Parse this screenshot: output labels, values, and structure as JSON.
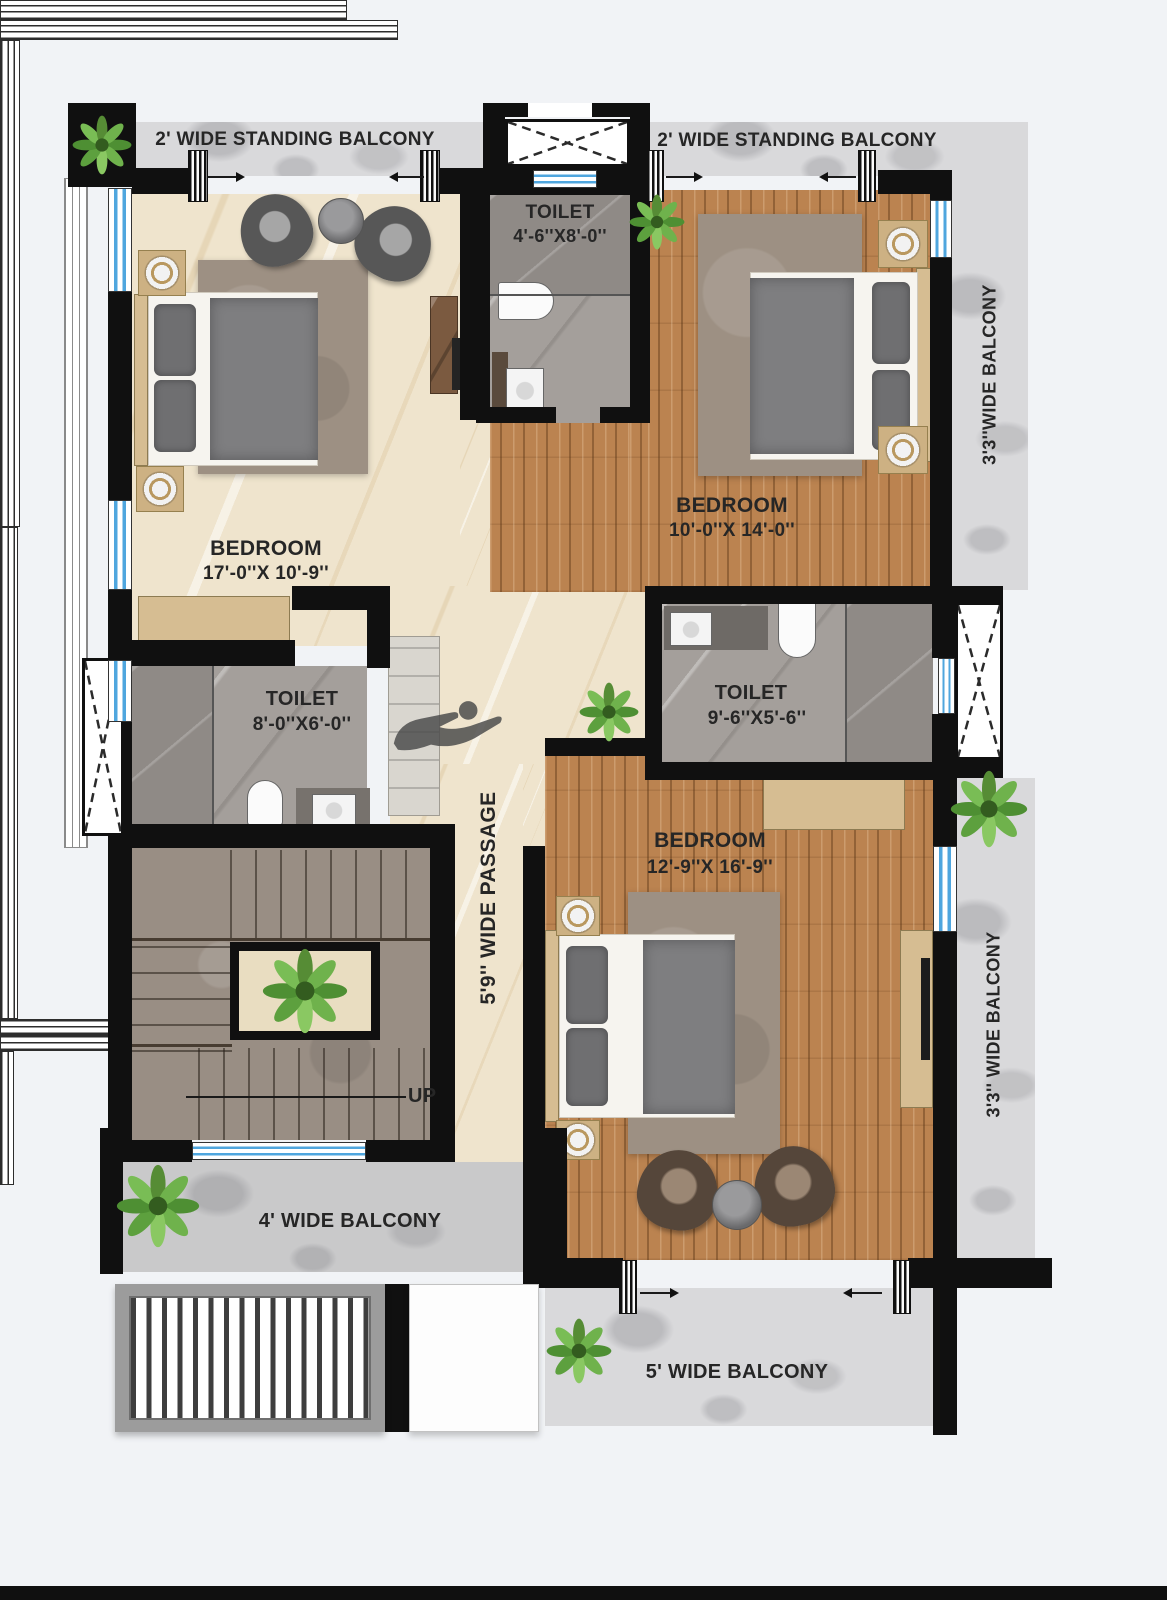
{
  "colors": {
    "wall": "#101010",
    "window_blue": "#4fa6de",
    "wood_floor": "#bb8350",
    "cream_floor": "#efe4cd",
    "balcony_marble": "#d9d9db",
    "toilet_tile": "#a49f9b",
    "stair_stone": "#998e84",
    "text": "#262626",
    "background": "#f1f3f6"
  },
  "balconies": {
    "standing_left": "2' WIDE STANDING BALCONY",
    "standing_right": "2' WIDE STANDING BALCONY",
    "right_upper": "3'3''WIDE BALCONY",
    "right_lower": "3'3'' WIDE BALCONY",
    "bottom_left": "4' WIDE BALCONY",
    "bottom_center": "5' WIDE BALCONY"
  },
  "rooms": {
    "bedroom_left": {
      "name": "BEDROOM",
      "dims": "17'-0''X 10'-9''"
    },
    "bedroom_right": {
      "name": "BEDROOM",
      "dims": "10'-0''X 14'-0''"
    },
    "bedroom_bottom": {
      "name": "BEDROOM",
      "dims": "12'-9''X 16'-9''"
    },
    "toilet_top": {
      "name": "TOILET",
      "dims": "4'-6''X8'-0''"
    },
    "toilet_left": {
      "name": "TOILET",
      "dims": "8'-0''X6'-0''"
    },
    "toilet_right": {
      "name": "TOILET",
      "dims": "9'-6''X5'-6''"
    }
  },
  "passage": {
    "label": "5'9'' WIDE PASSAGE"
  },
  "stairs": {
    "up_label": "UP"
  }
}
